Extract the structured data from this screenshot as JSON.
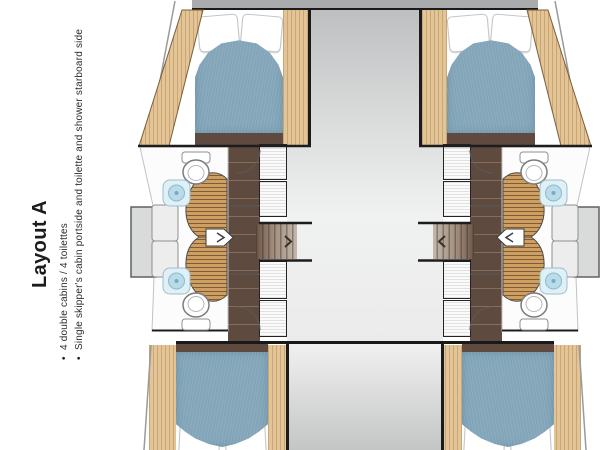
{
  "caption": {
    "title": "Layout A",
    "bullets": [
      "4 double cabins / 4 toilettes",
      "Single skipper's cabin portside and toilette and shower starboard side"
    ]
  },
  "colors": {
    "mattress_blue": "#82a5b9",
    "light_wood": "#e3c496",
    "walnut_floor": "#5e4a3e",
    "teak_grating": "#cf9f62",
    "deck_gray": "#d6d7d7"
  }
}
